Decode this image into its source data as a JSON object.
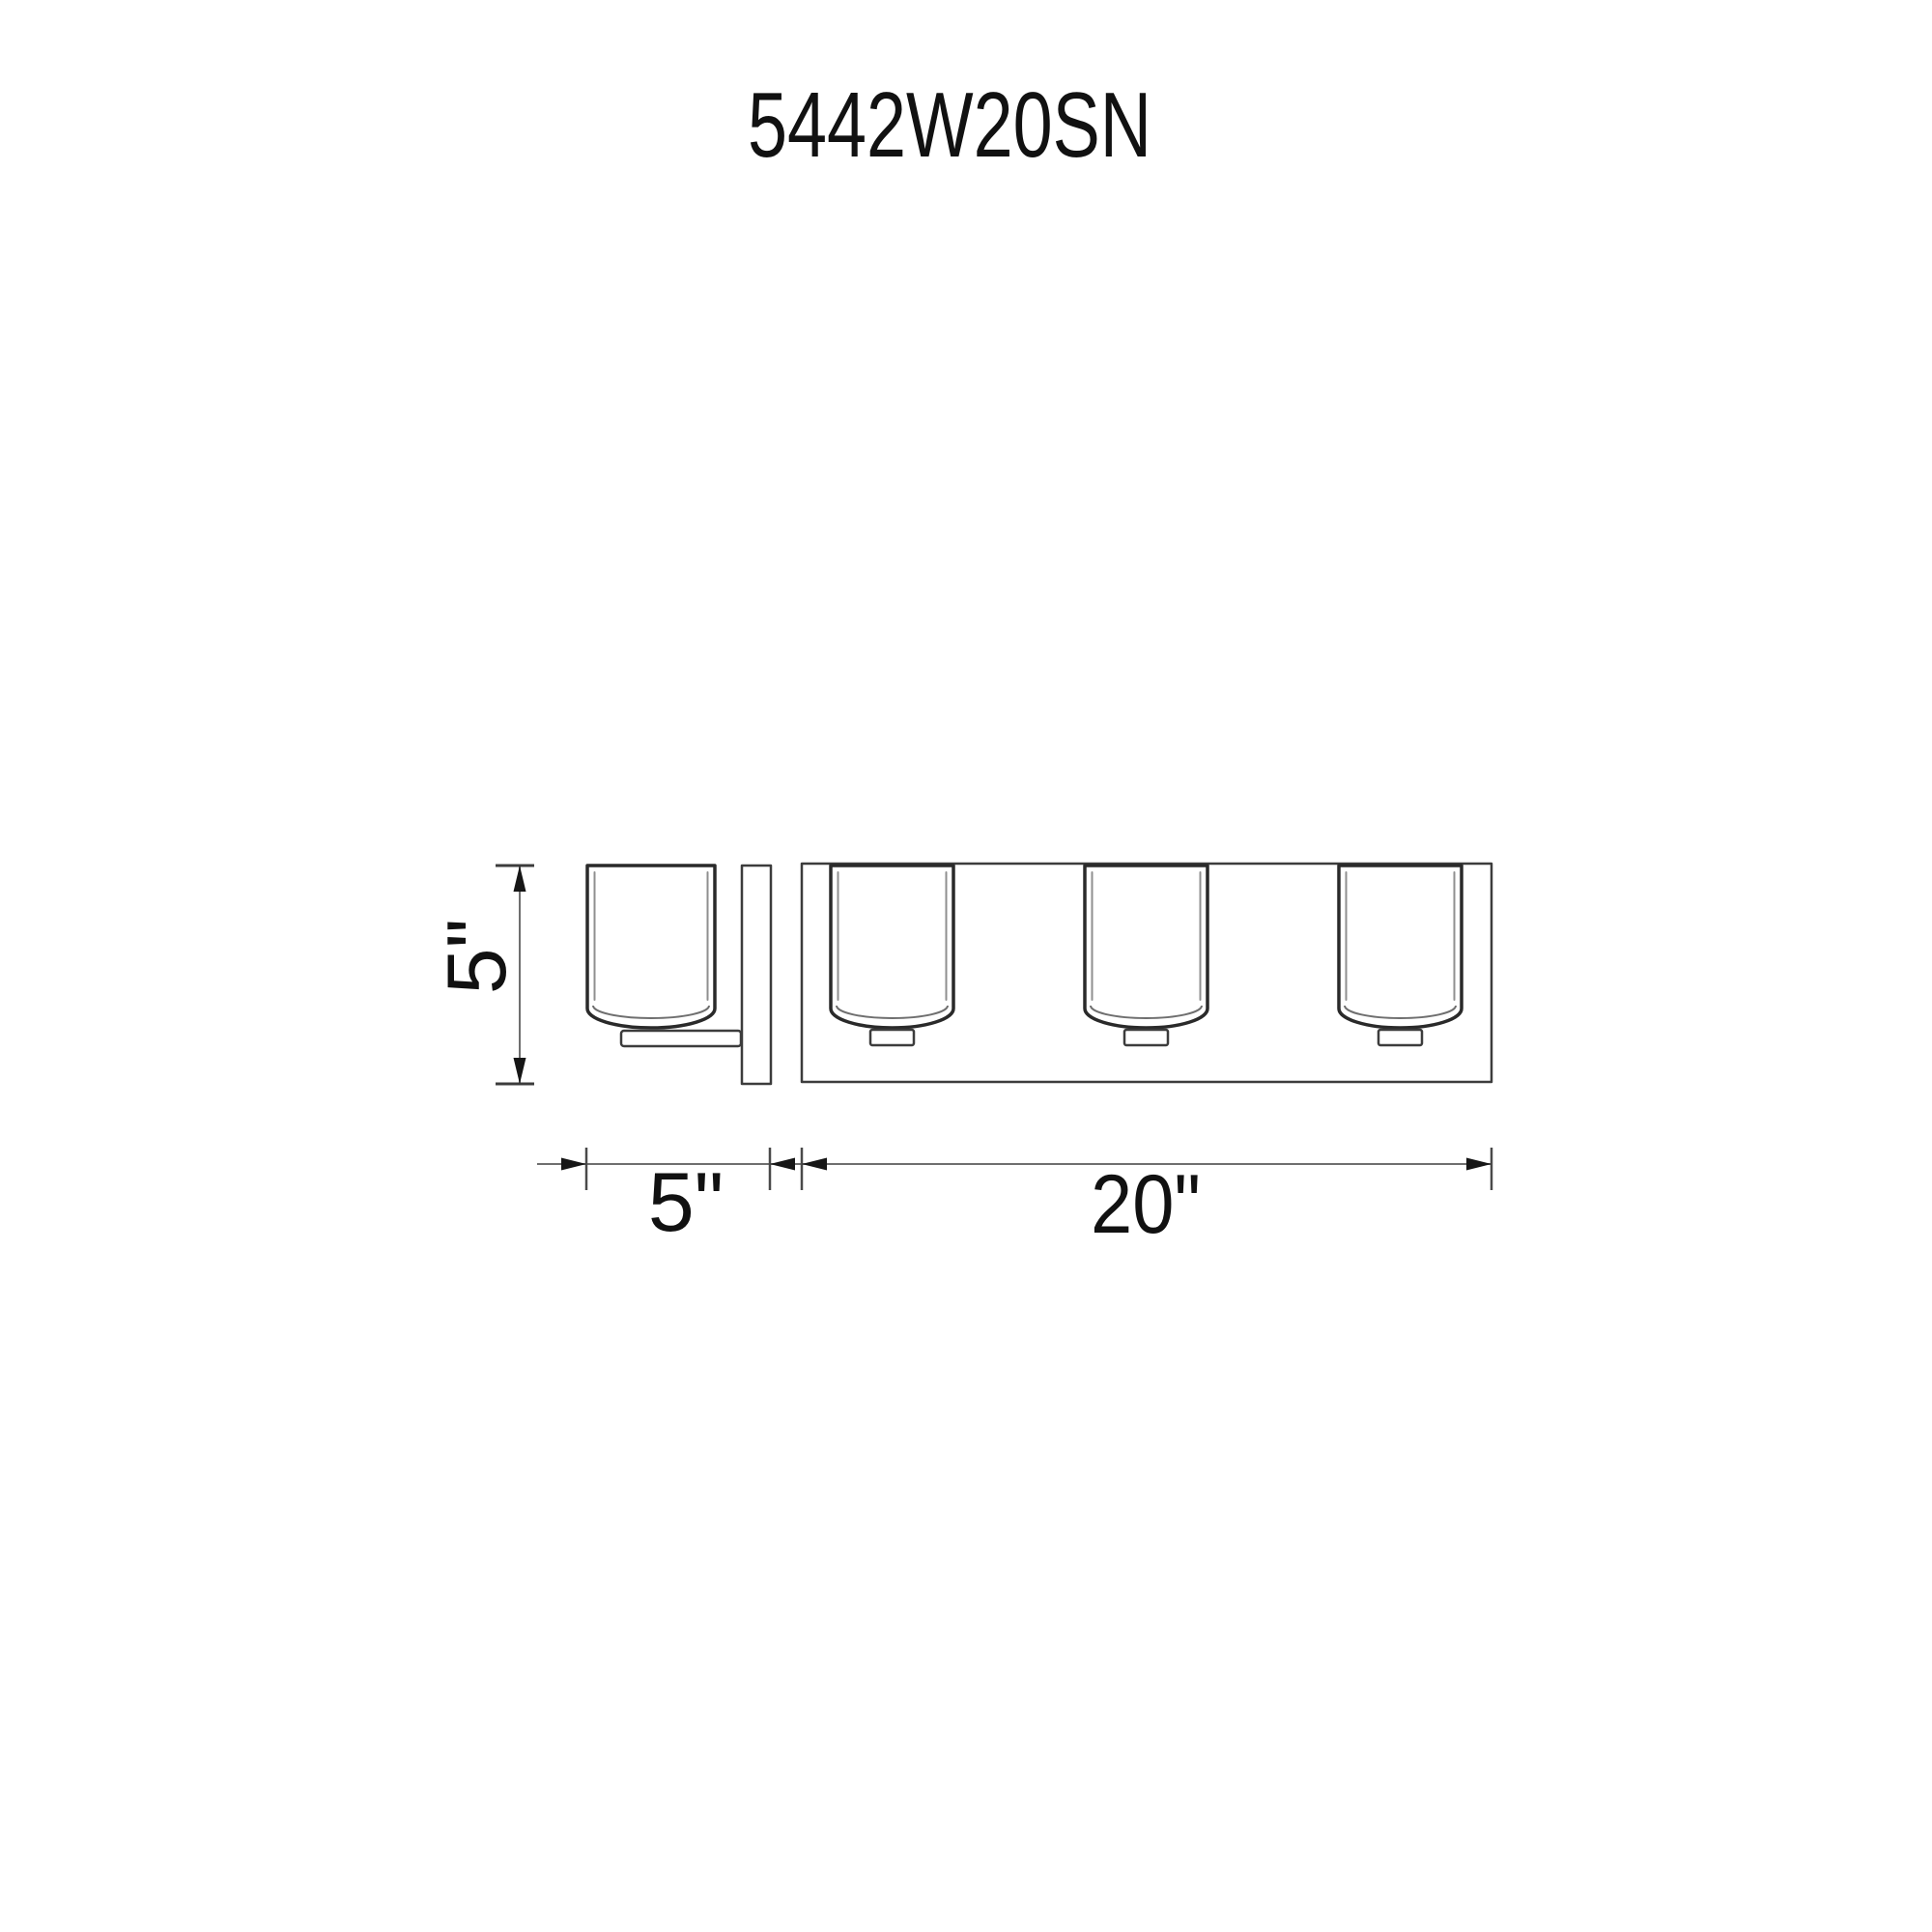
{
  "title": "5442W20SN",
  "drawing": {
    "shade_count": 3,
    "dimension_labels": {
      "height": "5\"",
      "depth": "5\"",
      "width": "20\""
    },
    "colors": {
      "background": "#ffffff",
      "outline": "#2a2a2a",
      "fixture_line": "#3c3c3c",
      "inner_line": "#8f8f8f",
      "dimension_line": "#6f6f6f",
      "text": "#111111"
    }
  }
}
